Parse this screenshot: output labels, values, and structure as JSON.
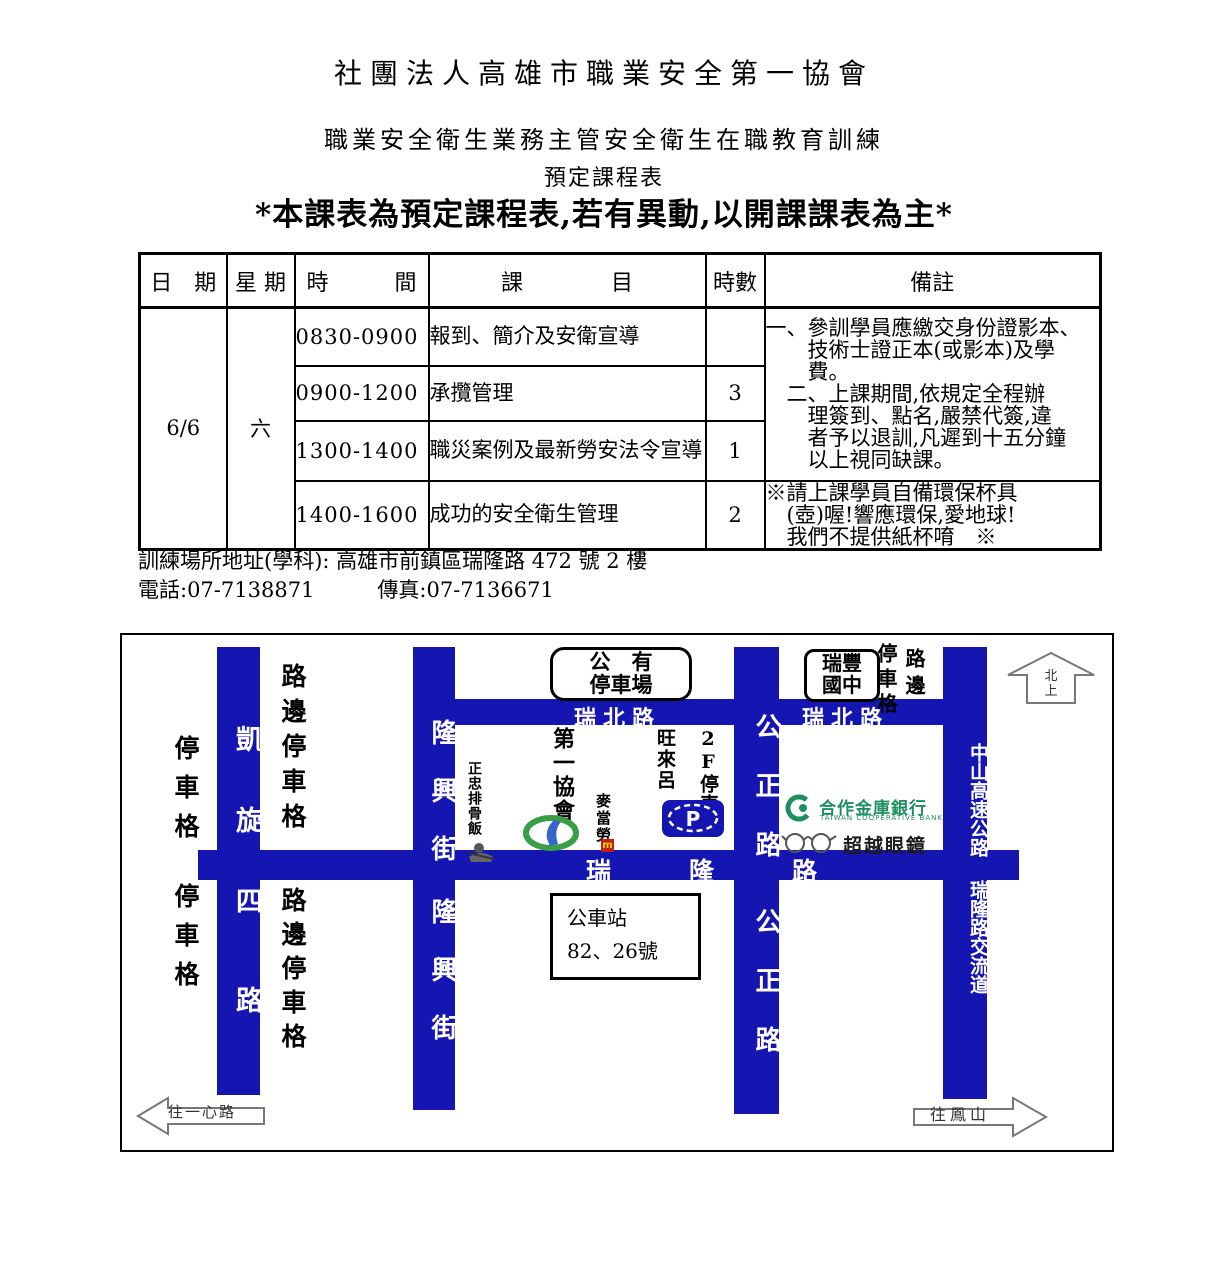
{
  "titles": {
    "organization": "社團法人高雄市職業安全第一協會",
    "course_line": "職業安全衛生業務主管安全衛生在職教育訓練",
    "schedule_line": "預定課程表",
    "notice": "*本課表為預定課程表,若有異動,以開課課表為主*"
  },
  "schedule_table": {
    "headers": {
      "date": "日　期",
      "weekday": "星 期",
      "time": "時　　　間",
      "subject": "課　　　　目",
      "hours": "時數",
      "remarks": "備註"
    },
    "date": "6/6",
    "weekday": "六",
    "rows": [
      {
        "time": "0830-0900",
        "subject": "報到、簡介及安衛宣導",
        "hours": ""
      },
      {
        "time": "0900-1200",
        "subject": "承攬管理",
        "hours": "3"
      },
      {
        "time": "1300-1400",
        "subject": "職災案例及最新勞安法令宣導",
        "hours": "1"
      },
      {
        "time": "1400-1600",
        "subject": "成功的安全衛生管理",
        "hours": "2"
      }
    ],
    "remarks_main": "一、參訓學員應繳交身份證影本、\n　　技術士證正本(或影本)及學\n　　費。\n　二、上課期間,依規定全程辦\n　　理簽到、點名,嚴禁代簽,違\n　　者予以退訓,凡遲到十五分鐘\n　　以上視同缺課。",
    "remarks_eco": "※請上課學員自備環保杯具\n　(壺)喔!響應環保,愛地球!\n　我們不提供紙杯唷　※"
  },
  "footer": {
    "address": "訓練場所地址(學科): 高雄市前鎮區瑞隆路 472 號 2 樓",
    "phone_fax": "電話:07-7138871　　　傳真:07-7136671"
  },
  "map": {
    "colors": {
      "road_blue": "#1515b2",
      "bank_green": "#1f8f5f",
      "mcdonalds_red": "#bb2211"
    },
    "roads": {
      "kaixuan_upper": "凱旋",
      "kaixuan_lower": "四路",
      "longxing": "隆興街",
      "gongzheng": "公正路",
      "ruibei": "瑞北路",
      "ruilong": "瑞隆路",
      "highway": "中山高速公路",
      "interchange": "瑞隆路交流道"
    },
    "labels": {
      "parking_spaces": "停車格",
      "curbside_parking": "路邊停車格",
      "roadside": "路邊",
      "north_arrow": "北上",
      "to_yixin_road": "往一心路",
      "to_fengshan": "往鳳山"
    },
    "places": {
      "public_parking": "公　有\n停車場",
      "ruifeng_school": "瑞豐\n國中",
      "bus_stop": "公車站\n82、26號",
      "association": "第一協會",
      "zhengzhong_restaurant": "正忠排骨飯",
      "mcdonalds": "麥當勞",
      "mcdonalds_m": "m",
      "wanglai": "旺來呂",
      "parking_2f": "2F停車場",
      "p_sign": "P",
      "bank_name": "合作金庫銀行",
      "bank_sub": "TAIWAN COOPERATIVE BANK",
      "glasses_shop": "超越眼鏡"
    }
  }
}
